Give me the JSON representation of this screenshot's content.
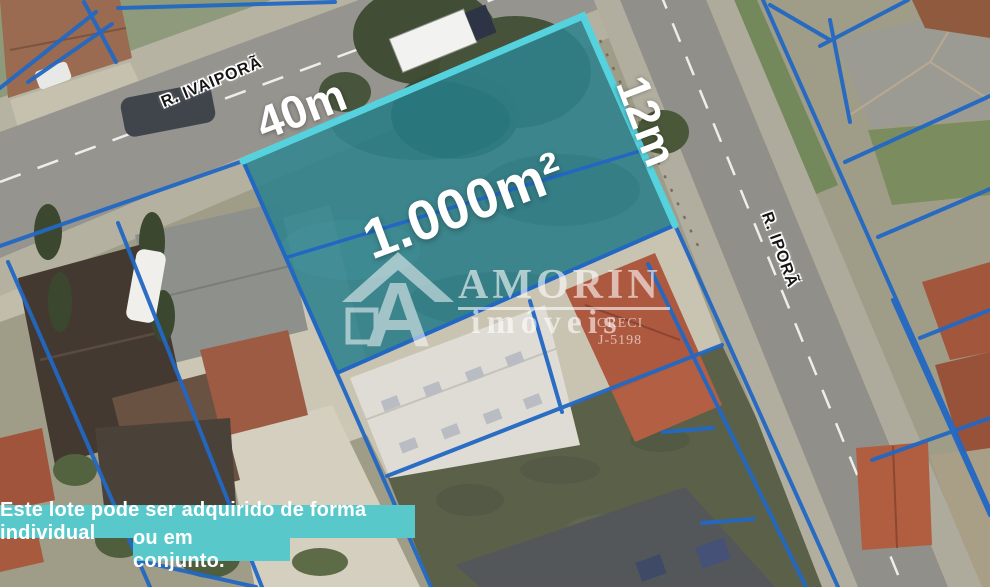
{
  "map": {
    "street_top_label": "R. IVAIPORÃ",
    "street_right_label": "R. IPORÃ"
  },
  "lot": {
    "area_label": "1.000m²",
    "frontage_label": "40m",
    "side_label": "12m"
  },
  "watermark": {
    "brand": "AMORIN",
    "subtitle": "imóveis",
    "creci_label": "CRECI",
    "creci_number": "J-5198"
  },
  "banner": {
    "line1": "Este lote pode ser adquirido de forma individual",
    "line2": "ou em conjunto."
  },
  "colors": {
    "highlight_fill": "#2F828C",
    "highlight_border": "#55D2DD",
    "boundary_blue": "#2268C3",
    "banner_teal": "#58C8CB",
    "label_white": "#FFFFFF"
  }
}
